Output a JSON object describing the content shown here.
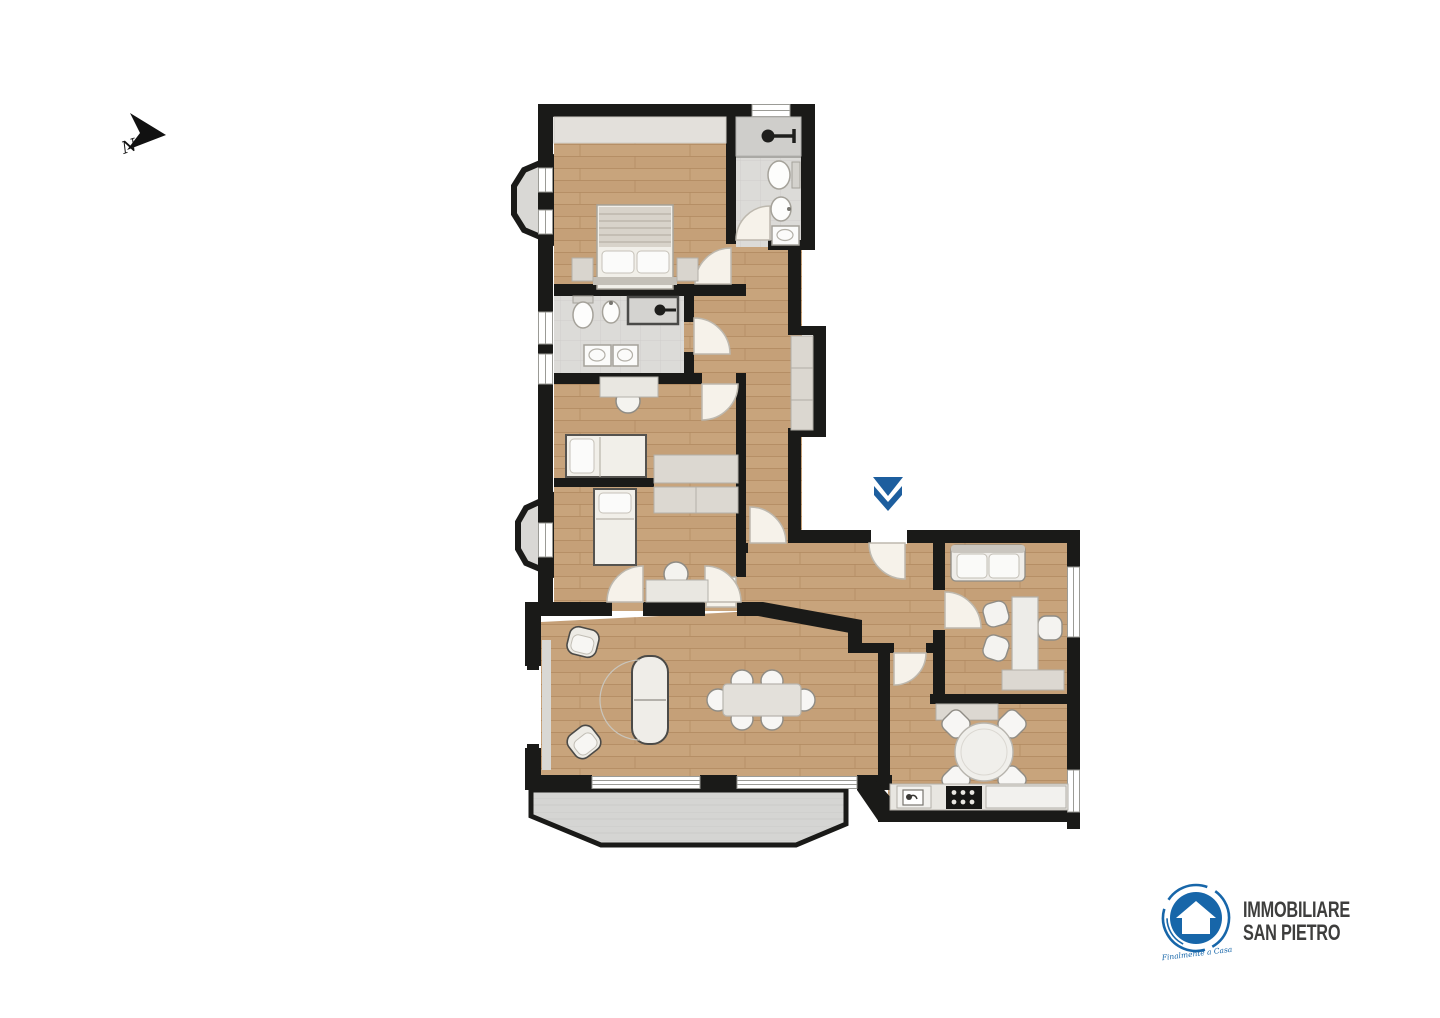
{
  "compass": {
    "label": "N"
  },
  "entrance_marker": {
    "icon": "double-chevron-down",
    "color": "#1d5e9e"
  },
  "palette": {
    "wall": "#1a1a18",
    "wood_floor": "#c8a47c",
    "wood_seam": "#b28a60",
    "tile_floor": "#dcdbd8",
    "shower_tile": "#cfcecb",
    "terrace_floor": "#d5d5d3",
    "furniture_white": "#f2f1ee",
    "furniture_gray": "#dcd8d1",
    "accent_blue": "#1d5e9e",
    "logo_blue": "#1766a9"
  },
  "floor_plan": {
    "type": "apartment-floor-plan",
    "rooms": [
      {
        "id": "bedroom-1",
        "position": "top-left",
        "furniture": [
          "double-bed",
          "pillows",
          "nightstand-left",
          "nightstand-right",
          "wardrobe-band"
        ]
      },
      {
        "id": "bathroom-1",
        "position": "top-right",
        "fixtures": [
          "shower",
          "toilet",
          "bidet",
          "washbasin"
        ]
      },
      {
        "id": "hallway",
        "position": "center-vertical",
        "furniture": [
          "built-in-wardrobe"
        ]
      },
      {
        "id": "bathroom-2",
        "position": "middle-left",
        "fixtures": [
          "toilet",
          "bidet",
          "shower-box",
          "washbasin",
          "washbasin"
        ]
      },
      {
        "id": "bedroom-2",
        "position": "middle-left",
        "furniture": [
          "desk",
          "chair",
          "single-bed",
          "wardrobe"
        ]
      },
      {
        "id": "bedroom-3",
        "position": "middle-left",
        "furniture": [
          "single-bed",
          "wardrobe",
          "desk",
          "chair"
        ]
      },
      {
        "id": "living-dining-room",
        "position": "bottom-left",
        "furniture": [
          "armchair",
          "armchair",
          "sofa",
          "dining-table",
          "dining-chairs-x6",
          "radiator"
        ]
      },
      {
        "id": "entrance-hall",
        "position": "center",
        "furniture": []
      },
      {
        "id": "study",
        "position": "right",
        "furniture": [
          "loveseat",
          "desk",
          "chair",
          "chair",
          "chair",
          "closet"
        ]
      },
      {
        "id": "kitchen",
        "position": "bottom-right",
        "furniture": [
          "round-table",
          "chairs-x4",
          "counter",
          "sink",
          "cooktop",
          "closet"
        ]
      },
      {
        "id": "terrace",
        "position": "bottom",
        "furniture": []
      },
      {
        "id": "bay-window-upper",
        "position": "left"
      },
      {
        "id": "bay-window-lower",
        "position": "left"
      }
    ]
  },
  "logo": {
    "line1": "IMMOBILIARE",
    "line2": "SAN PIETRO",
    "tagline": "Finalmente a Casa",
    "circle_color": "#1766a9",
    "text_color": "#3e3e3d"
  }
}
